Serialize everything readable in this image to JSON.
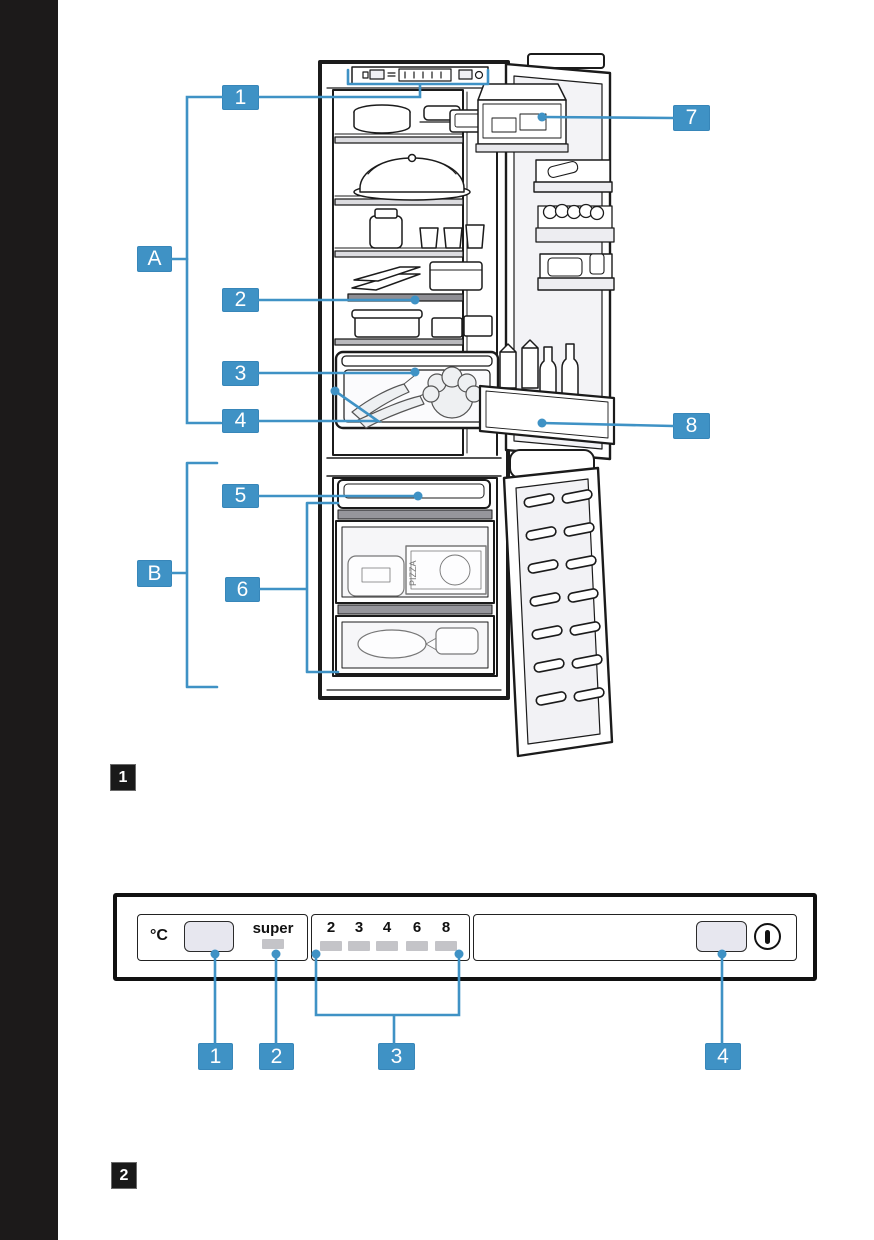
{
  "page": {
    "background": "#ffffff",
    "left_bar_color": "#1c1a1a"
  },
  "colors": {
    "callout_blue": "#3F92C5",
    "line_black": "#1b1b1b",
    "led_gray": "#c4c4c8",
    "button_fill": "#e7e7ef",
    "dark_shelf_gray": "#8e8e94"
  },
  "icons": {
    "power": "standby-circle-with-bar"
  },
  "figure1": {
    "figure_number": "1",
    "callouts": {
      "1": "1",
      "2": "2",
      "3": "3",
      "4": "4",
      "5": "5",
      "6": "6",
      "7": "7",
      "8": "8",
      "A": "A",
      "B": "B"
    },
    "art_text": {
      "pizza_box": "PIZZA"
    }
  },
  "figure2": {
    "figure_number": "2",
    "panel": {
      "temp_unit": "°C",
      "super_label": "super",
      "temp_scale": [
        "2",
        "3",
        "4",
        "6",
        "8"
      ]
    },
    "callouts": {
      "1": "1",
      "2": "2",
      "3": "3",
      "4": "4"
    }
  }
}
